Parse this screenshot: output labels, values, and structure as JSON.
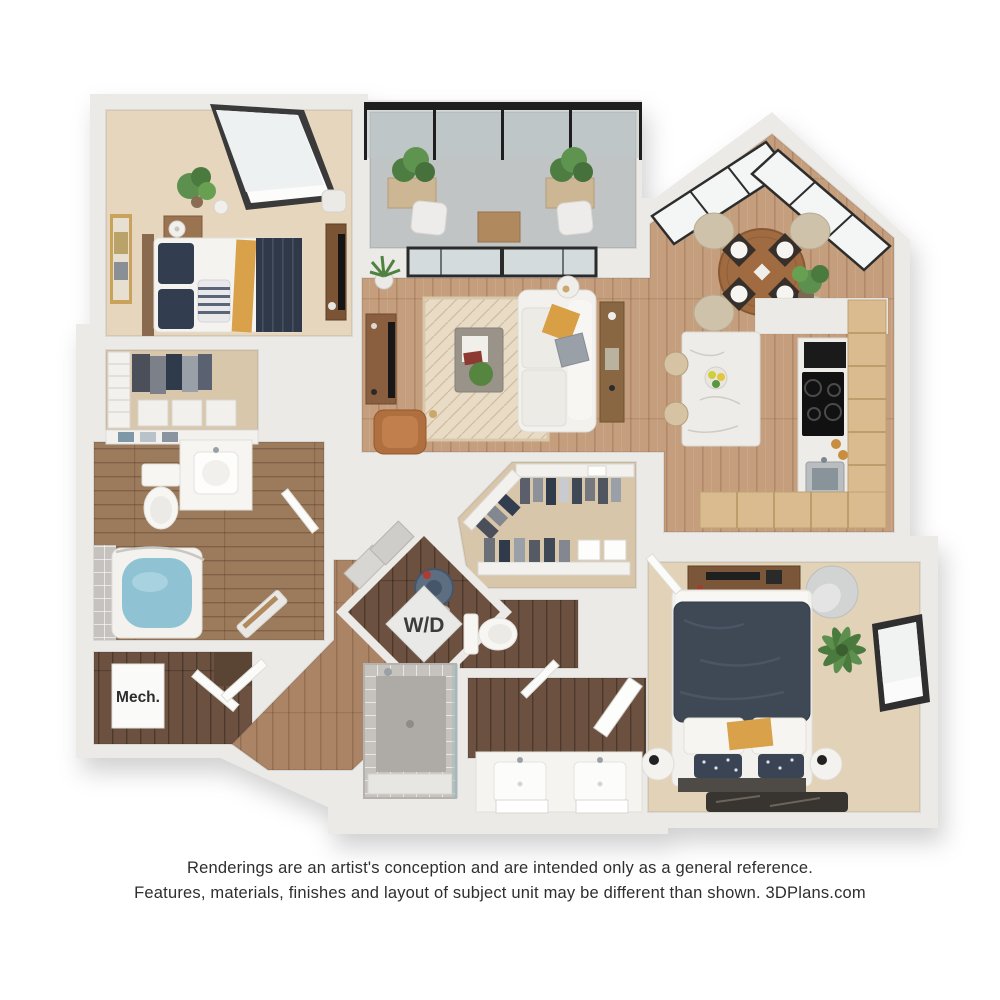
{
  "floor_plan": {
    "type": "3d-apartment-floor-plan-rendering",
    "labels": {
      "washer_dryer": "W/D",
      "mechanical": "Mech."
    },
    "palette": {
      "background": "#ffffff",
      "wall": "#ebeae7",
      "wood_floor": "#c59e7d",
      "hall_wood": "#ab8466",
      "dark_wood": "#6d5140",
      "bath_wood": "#9c7a5c",
      "carpet": "#e6d6bd",
      "closet_carpet": "#d8c6aa",
      "tan_cabinet": "#dabb8f",
      "marble": "#edece8",
      "concrete": "#c1c4c4",
      "shower_tile": "#c6c3bf",
      "tub_water": "#8fc3d4",
      "navy_bedding": "#3f4855",
      "mustard_accent": "#d9a24a",
      "leather_chair": "#b06f3e",
      "plant_green": "#5d8f4e",
      "black_frame": "#222222",
      "white_furniture": "#f3f2ef"
    }
  },
  "disclaimer": {
    "line1": "Renderings are an artist's conception and are intended only as a general reference.",
    "line2": "Features, materials, finishes and layout of subject unit may be different than shown. 3DPlans.com"
  }
}
